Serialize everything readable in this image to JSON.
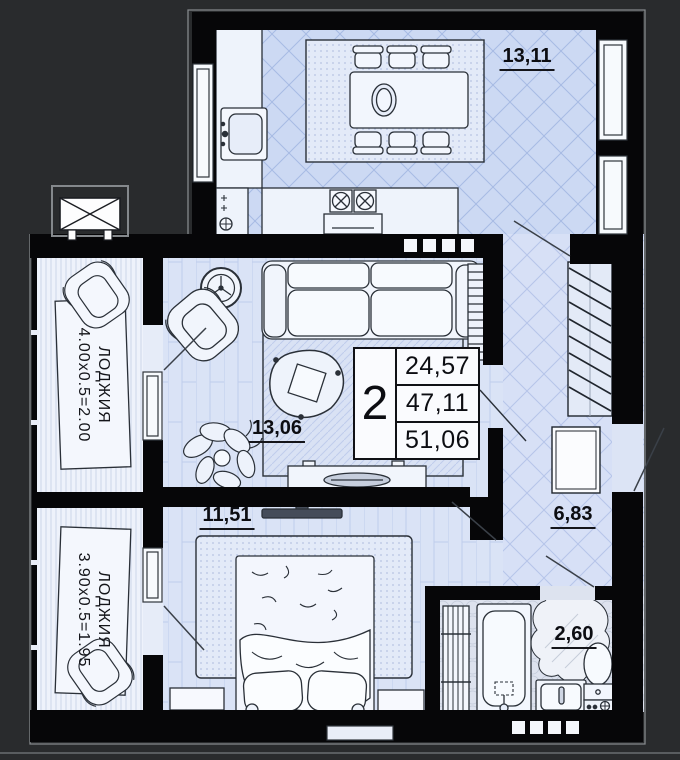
{
  "plan": {
    "info_box": {
      "rooms_count": "2",
      "values": [
        "24,57",
        "47,11",
        "51,06"
      ]
    },
    "rooms": {
      "kitchen": {
        "area": "13,11"
      },
      "living": {
        "area": "13,06"
      },
      "bedroom": {
        "area": "11,51"
      },
      "hallway": {
        "area": "6,83"
      },
      "bathroom": {
        "area": "2,60"
      },
      "loggia_top": {
        "name": "ЛОДЖИЯ",
        "dims": "4.00х0.5=2.00"
      },
      "loggia_bottom": {
        "name": "ЛОДЖИЯ",
        "dims": "3.90х0.5=1.95"
      }
    },
    "colors": {
      "background": "#292b2d",
      "wall": "#060608",
      "floor_light": "#ccd9f3",
      "pattern_line": "#a7bbe4",
      "label_text": "#0c0d12"
    }
  }
}
